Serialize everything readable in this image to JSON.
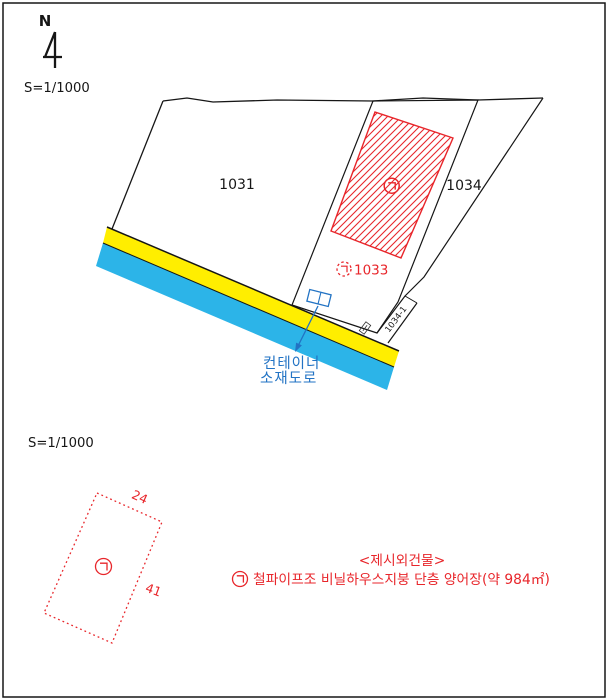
{
  "north_arrow": {
    "label": "N"
  },
  "site_map": {
    "scale_label": "S=1/1000",
    "parcels": {
      "left": {
        "number": "1031"
      },
      "right": {
        "number": "1034"
      },
      "subject": {
        "symbol": "㉠",
        "number": "1033"
      },
      "sliver": {
        "number": "1034-1"
      }
    },
    "building_symbol": "㉠",
    "container_annotation": {
      "line1": "컨테이너",
      "line2": "소재도로"
    }
  },
  "building_sketch": {
    "scale_label": "S=1/1000",
    "symbol": "㉠",
    "width_label": "24",
    "length_label": "41"
  },
  "legend": {
    "title": "<제시외건물>",
    "symbol": "㉠",
    "description": "철파이프조 비닐하우스지붕 단층 양어장(약 984㎡)"
  },
  "colors": {
    "parcel_fill": "#f7d1d4",
    "hatch_red": "#e8262b",
    "road_yellow": "#ffee00",
    "road_cyan": "#2cb4e8",
    "annotation_blue": "#2273c4",
    "line_black": "#161616"
  }
}
